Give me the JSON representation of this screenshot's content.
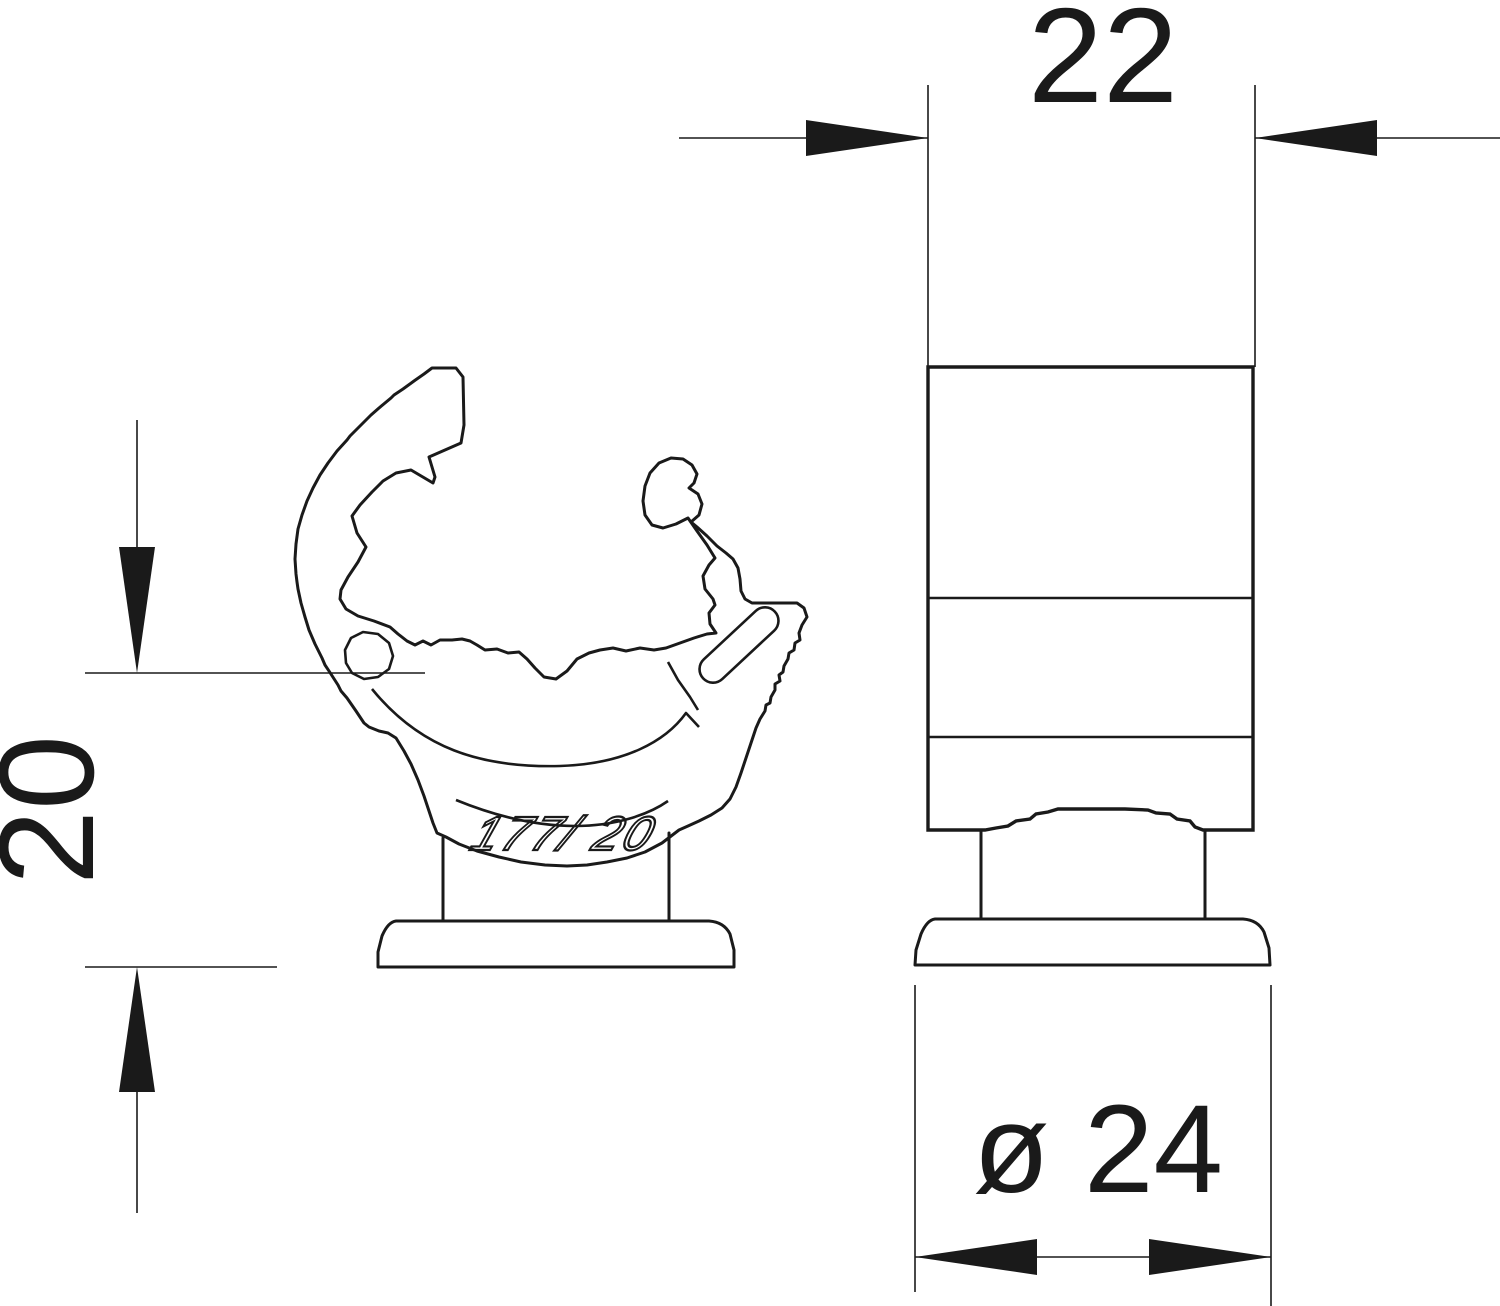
{
  "drawing": {
    "type": "technical-drawing",
    "description": "Two-view dimensioned drawing of a push-fit pipe clamp (front profile and side view)",
    "views": {
      "front": {
        "name": "front profile view",
        "marking": "177/ 20"
      },
      "side": {
        "name": "side view"
      }
    },
    "dimensions": {
      "width": {
        "label": "22"
      },
      "height": {
        "label": "20"
      },
      "diameter": {
        "label": "ø 24"
      }
    },
    "colors": {
      "line": "#1a1a1a",
      "background": "#ffffff"
    }
  }
}
